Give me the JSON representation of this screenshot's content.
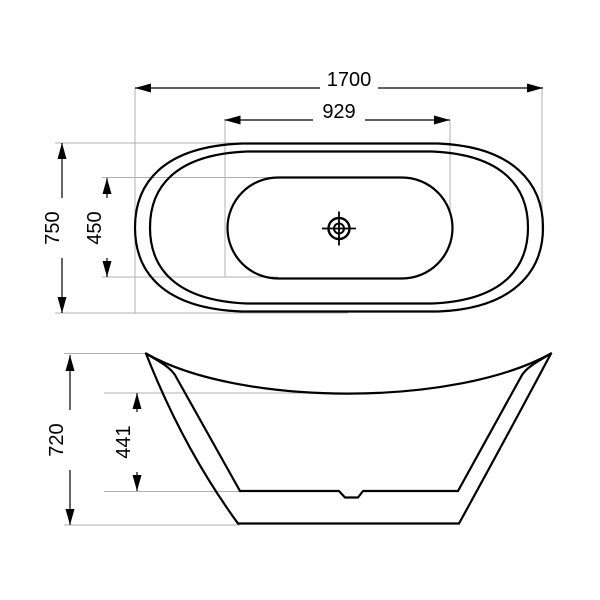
{
  "drawing": {
    "title": "bathtub-technical-drawing",
    "background": "#ffffff",
    "line_color": "#000000",
    "extension_line_color": "#b0b0b0",
    "views": {
      "top_view": {
        "name": "top view (plan)",
        "dimensions": {
          "overall_length": "1700",
          "basin_length": "929",
          "overall_width": "750",
          "basin_width": "450"
        }
      },
      "side_view": {
        "name": "side view (elevation)",
        "dimensions": {
          "overall_height": "720",
          "basin_depth": "441"
        }
      }
    }
  }
}
